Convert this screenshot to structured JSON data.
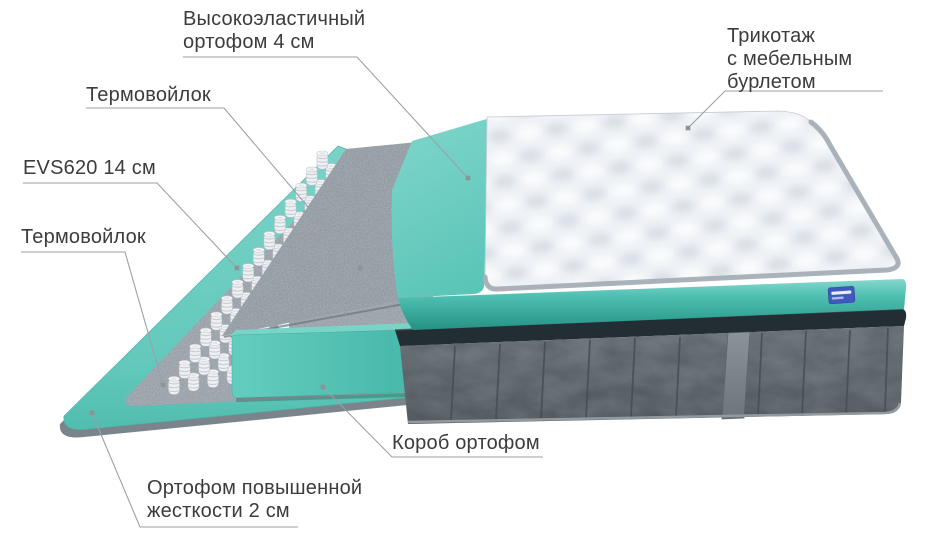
{
  "diagram": {
    "labels": {
      "top_foam": {
        "line1": "Высокоэластичный",
        "line2": "ортофом 4 см"
      },
      "felt_top": {
        "line1": "Термовойлок"
      },
      "springs": {
        "line1": "EVS620 14 см"
      },
      "felt_bottom": {
        "line1": "Термовойлок"
      },
      "knit_cover": {
        "line1": "Трикотаж",
        "line2": "с мебельным",
        "line3": "бурлетом"
      },
      "foam_box": {
        "line1": "Короб ортофом"
      },
      "base_foam": {
        "line1": "Ортофом повышенной",
        "line2": "жесткости 2 см"
      }
    },
    "colors": {
      "foam_teal": "#5fc8bb",
      "foam_teal_dark": "#2f9d90",
      "felt_gray": "#99a1a9",
      "base_gray": "#525a60",
      "base_band_dark": "#222e34",
      "cover_white": "#eef1f4",
      "piping_gray": "#a5aeb6",
      "leader_line": "#9aa1a5",
      "label_text": "#3c3c3c",
      "tag_blue": "#4059bd"
    }
  }
}
